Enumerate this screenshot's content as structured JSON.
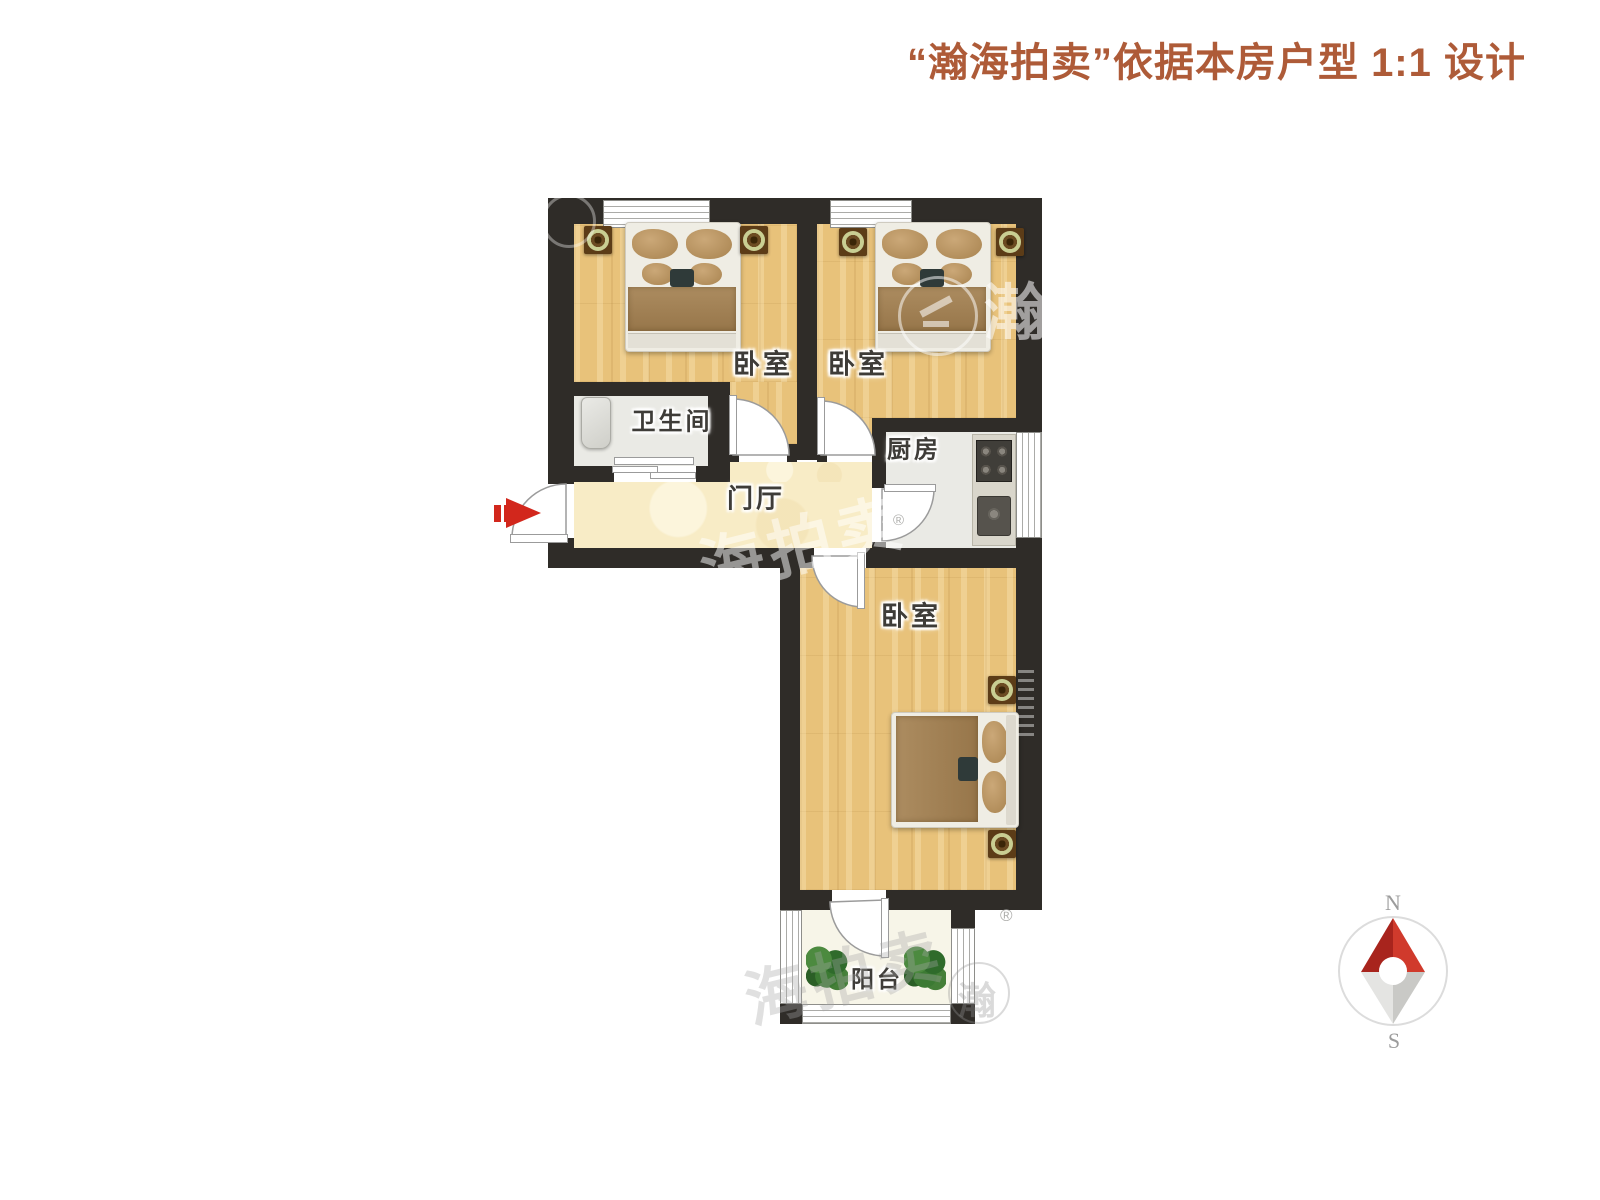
{
  "header": {
    "title": "“瀚海拍卖”依据本房户型 1:1 设计",
    "color": "#AE5B38"
  },
  "floorplan": {
    "rooms": [
      {
        "id": "bedroom-top-left",
        "label": "卧室"
      },
      {
        "id": "bedroom-top-right",
        "label": "卧室"
      },
      {
        "id": "bathroom",
        "label": "卫生间"
      },
      {
        "id": "kitchen",
        "label": "厨房"
      },
      {
        "id": "hall",
        "label": "门厅"
      },
      {
        "id": "bedroom-bottom",
        "label": "卧室"
      },
      {
        "id": "balcony",
        "label": "阳台"
      }
    ],
    "wall_color": "#2F2C28",
    "entry_arrow_color": "#D2271C"
  },
  "compass": {
    "north_label": "N",
    "south_label": "S",
    "north_color": "#C23327"
  },
  "watermarks": {
    "brand_char": "瀚",
    "brand_text": "海拍卖",
    "bottom_text": "海拍卖",
    "registered": "®"
  }
}
